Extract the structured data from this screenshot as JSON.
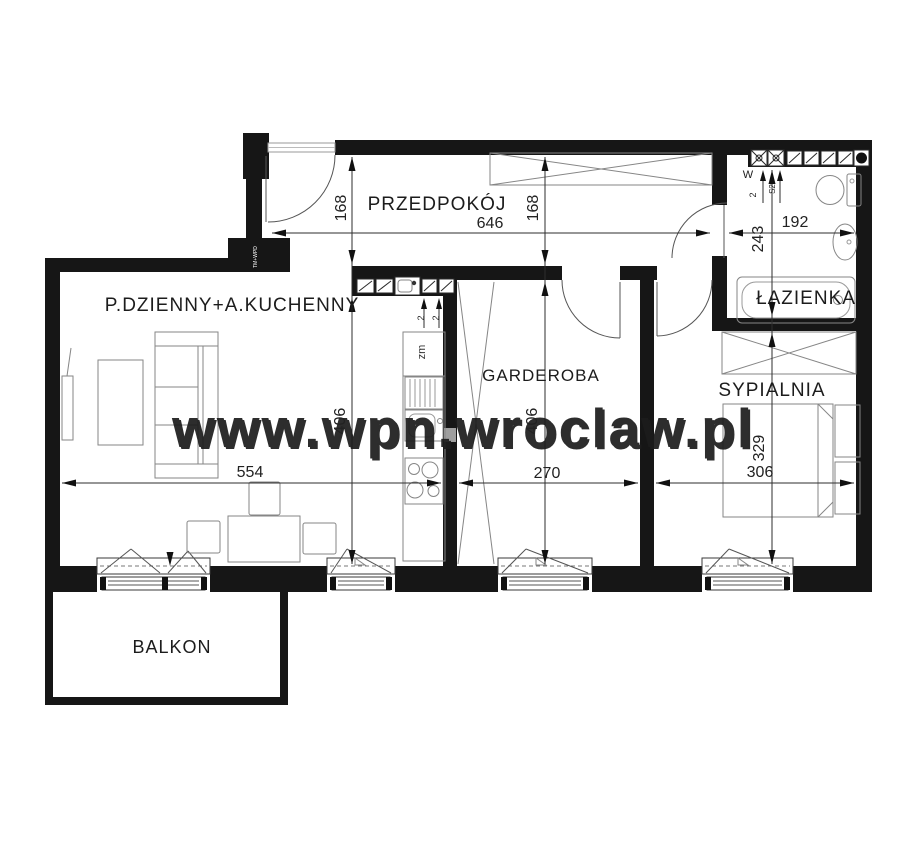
{
  "plan": {
    "watermark": "www.wpn.wroclaw.pl",
    "rooms": {
      "hallway": "PRZEDPOKÓJ",
      "living": "P.DZIENNY+A.KUCHENNY",
      "wardrobe": "GARDEROBA",
      "bathroom": "ŁAZIENKA",
      "bedroom": "SYPIALNIA",
      "balcony": "BALKON"
    },
    "dims": {
      "hall_width": "646",
      "hall_depth_left": "168",
      "hall_depth_right": "168",
      "bath_width": "192",
      "bath_depth": "243",
      "living_width": "554",
      "living_depth": "406",
      "wardrobe_width": "270",
      "wardrobe_depth": "406",
      "bedroom_width": "306",
      "bedroom_depth": "329",
      "bath_vent_offset": "2",
      "kitchen_vent_a": "2",
      "kitchen_vent_b": "2"
    },
    "labels": {
      "vent_w": "W",
      "vent_s2": "S2",
      "dishwasher": "zm",
      "entry_note": "TM+WPD"
    },
    "colors": {
      "wall": "#161616",
      "furniture_stroke": "#868686",
      "dimension": "#2e2e2e",
      "watermark": "#cdcdcd",
      "background": "#ffffff"
    }
  }
}
